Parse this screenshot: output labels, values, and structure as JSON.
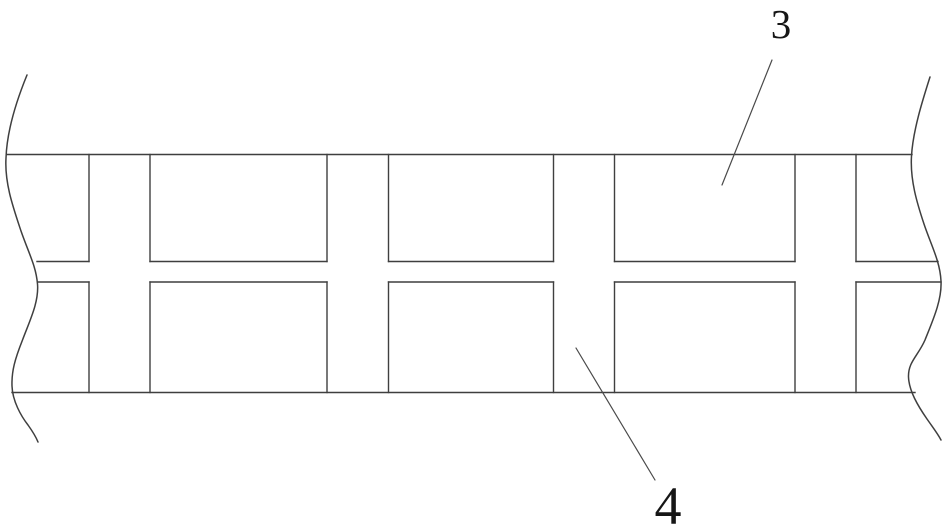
{
  "figure": {
    "background_color": "#ffffff",
    "line_color": "#3f3f3f",
    "annotation_line_color": "#4a4a4a",
    "label_color": "#161616",
    "labels": {
      "block_label": "3",
      "joint_label": "4"
    }
  }
}
